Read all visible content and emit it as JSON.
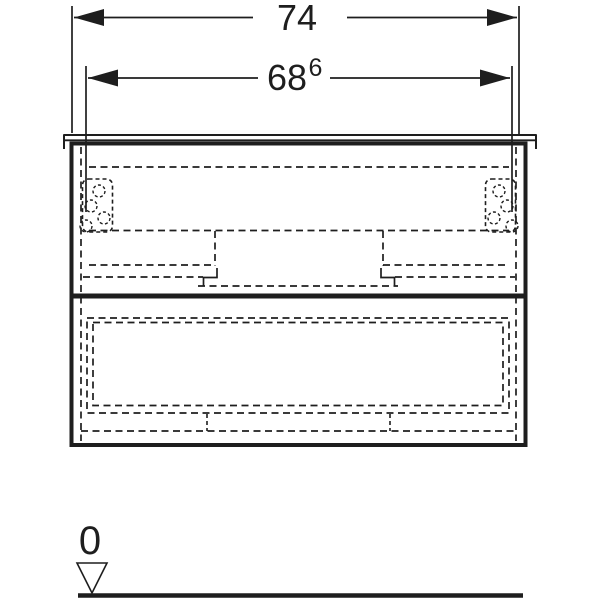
{
  "meta": {
    "background": "#ffffff",
    "line_color": "#1e1e1e",
    "drawing_type": "vanity-cabinet-front-elevation"
  },
  "dimensions": {
    "overall_width": {
      "value": "74"
    },
    "cabinet_width": {
      "value": "68",
      "superscript": "6"
    }
  },
  "datum": {
    "label": "0"
  }
}
